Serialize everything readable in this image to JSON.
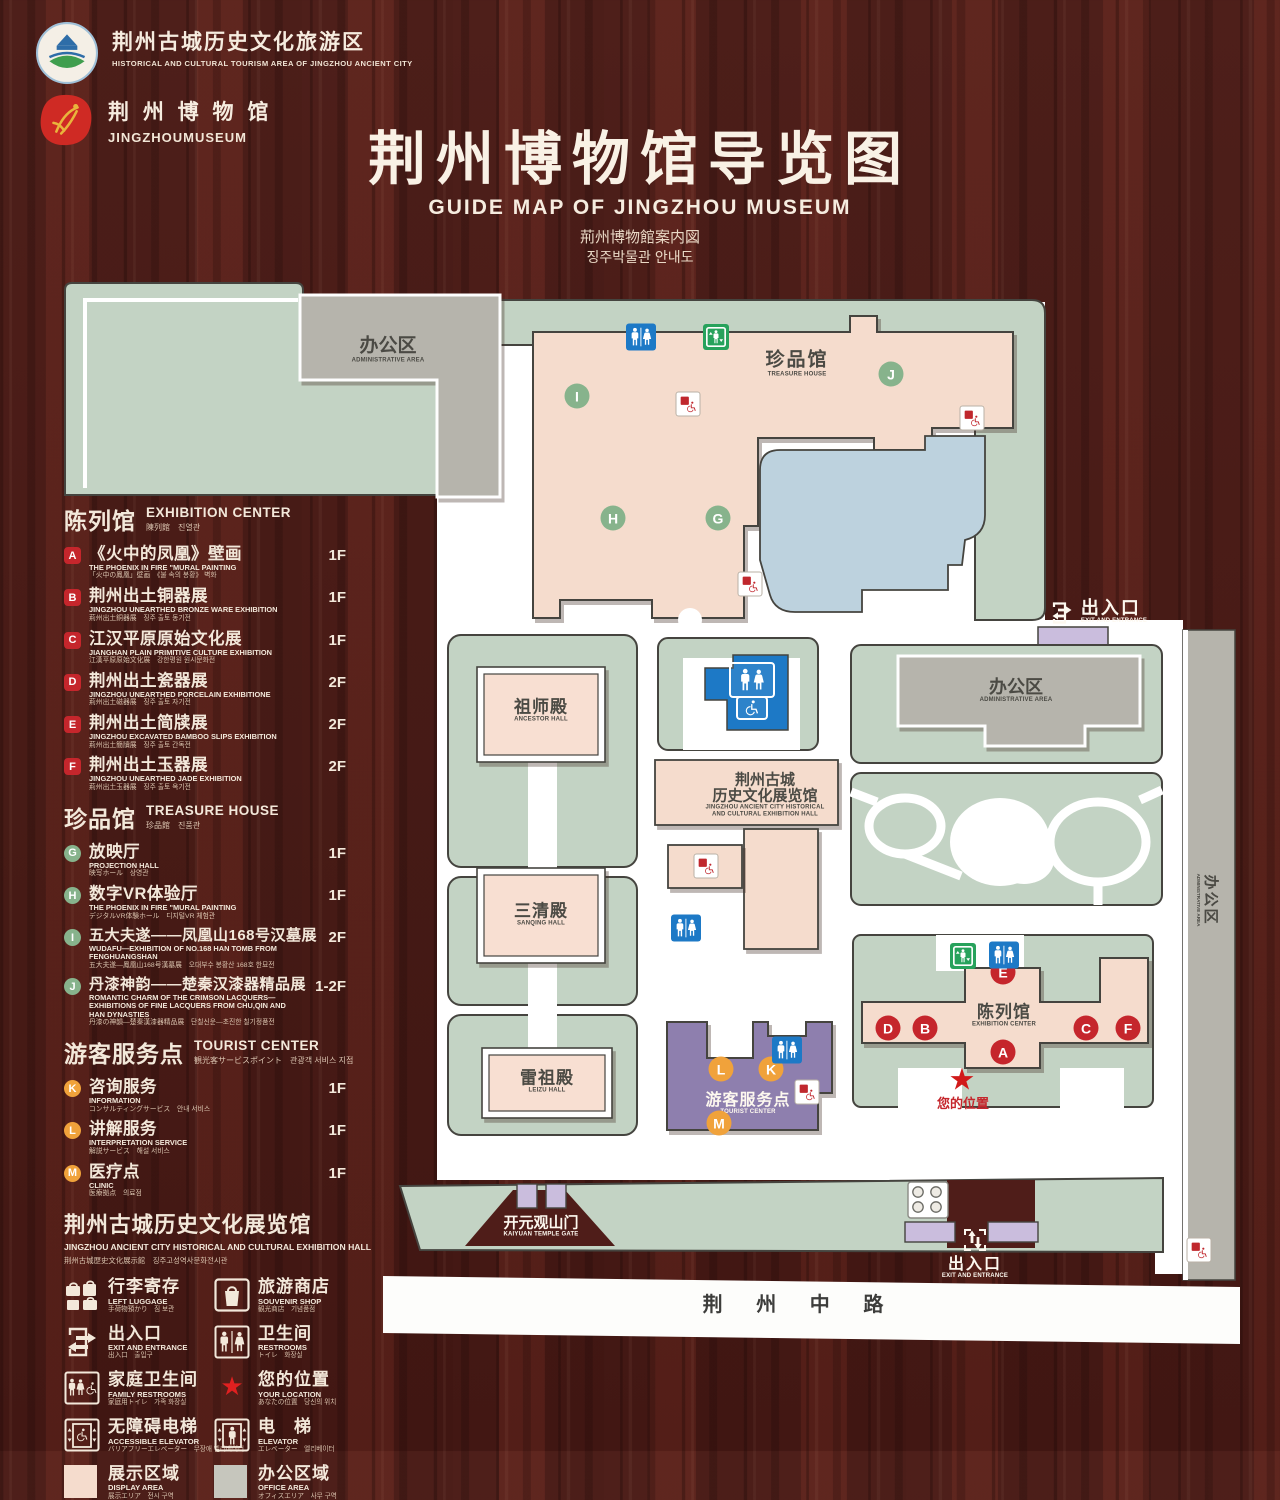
{
  "header": {
    "org1": {
      "cn": "荆州古城历史文化旅游区",
      "en": "HISTORICAL AND CULTURAL TOURISM AREA OF JINGZHOU ANCIENT CITY"
    },
    "org2": {
      "cn": "荆 州 博 物 馆",
      "en": "JINGZHOUMUSEUM"
    },
    "title": "荆州博物馆导览图",
    "subtitle_en": "GUIDE MAP OF JINGZHOU MUSEUM",
    "subtitle_jp": "荊州博物館案内図",
    "subtitle_kr": "징주박물관 안내도"
  },
  "legend": {
    "sections": [
      {
        "title_cn": "陈列馆",
        "title_en": "EXHIBITION CENTER",
        "title_sub": "陳列館　진열관",
        "items": [
          {
            "letter": "A",
            "name": "《火中的凤凰》壁画",
            "en": "THE PHOENIX IN FIRE \"MURAL PAINTING",
            "sub": "「火中の鳳凰」壁画　《불 속의 봉황》 벽화",
            "floor": "1F"
          },
          {
            "letter": "B",
            "name": "荆州出土铜器展",
            "en": "JINGZHOU UNEARTHED BRONZE WARE EXHIBITION",
            "sub": "荊州出土銅器展　징주 출토 동기전",
            "floor": "1F"
          },
          {
            "letter": "C",
            "name": "江汉平原原始文化展",
            "en": "JIANGHAN PLAIN PRIMITIVE CULTURE EXHIBITION",
            "sub": "江漢平原原始文化展　강한평원 원시문화전",
            "floor": "1F"
          },
          {
            "letter": "D",
            "name": "荆州出土瓷器展",
            "en": "JINGZHOU UNEARTHED PORCELAIN EXHIBITIONE",
            "sub": "荊州出土磁器展　징주 출토 자기전",
            "floor": "2F"
          },
          {
            "letter": "E",
            "name": "荆州出土简牍展",
            "en": "JINGZHOU EXCAVATED BAMBOO SLIPS EXHIBITION",
            "sub": "荊州出土簡牘展　징주 출토 간독전",
            "floor": "2F"
          },
          {
            "letter": "F",
            "name": "荆州出土玉器展",
            "en": "JINGZHOU UNEARTHED JADE EXHIBITION",
            "sub": "荊州出土玉器展　징주 출토 옥기전",
            "floor": "2F"
          }
        ]
      },
      {
        "title_cn": "珍品馆",
        "title_en": "TREASURE HOUSE",
        "title_sub": "珍品館　진품관",
        "items": [
          {
            "letter": "G",
            "name": "放映厅",
            "en": "PROJECTION HALL",
            "sub": "映写ホール　상영관",
            "floor": "1F"
          },
          {
            "letter": "H",
            "name": "数字VR体验厅",
            "en": "THE PHOENIX IN FIRE \"MURAL PAINTING",
            "sub": "デジタルVR体験ホール　디지털VR 체험관",
            "floor": "1F"
          },
          {
            "letter": "I",
            "name": "五大夫遂——凤凰山168号汉墓展",
            "en": "WUDAFU—EXHIBITION OF NO.168 HAN TOMB FROM FENGHUANGSHAN",
            "sub": "五大夫遂—鳳凰山168号漢墓展　오대부수 봉황산 168호 한묘전",
            "floor": "2F"
          },
          {
            "letter": "J",
            "name": "丹漆神韵——楚秦汉漆器精品展",
            "en": "ROMANTIC CHARM OF THE CRIMSON LACQUERS— EXHIBITIONS OF FINE LACQUERS FROM CHU,QIN AND HAN DYNASTIES",
            "sub": "丹漆の神韻—楚秦漢漆器精品展　단칠신운—초진한 칠기정품전",
            "floor": "1-2F"
          }
        ]
      },
      {
        "title_cn": "游客服务点",
        "title_en": "TOURIST CENTER",
        "title_sub": "観光客サービスポイント　관광객 서비스 지점",
        "items": [
          {
            "letter": "K",
            "name": "咨询服务",
            "en": "INFORMATION",
            "sub": "コンサルティングサービス　안내 서비스",
            "floor": "1F"
          },
          {
            "letter": "L",
            "name": "讲解服务",
            "en": "INTERPRETATION SERVICE",
            "sub": "解説サービス　해설 서비스",
            "floor": "1F"
          },
          {
            "letter": "M",
            "name": "医疗点",
            "en": "CLINIC",
            "sub": "医療拠点　의료점",
            "floor": "1F"
          }
        ]
      }
    ],
    "hall_note": {
      "cn": "荆州古城历史文化展览馆",
      "en": "JINGZHOU ANCIENT CITY HISTORICAL AND CULTURAL EXHIBITION HALL",
      "sub": "荆州古城歴史文化展示館　징주고성역사문화전시관"
    },
    "facilities": [
      {
        "cn": "行李寄存",
        "en": "LEFT LUGGAGE",
        "sub": "手荷物預かり　짐 보관",
        "icon": "luggage-icon"
      },
      {
        "cn": "旅游商店",
        "en": "SOUVENIR SHOP",
        "sub": "観光商店　기념품점",
        "icon": "souvenir-icon"
      },
      {
        "cn": "出入口",
        "en": "EXIT AND ENTRANCE",
        "sub": "出入口　출입구",
        "icon": "exit-entrance-icon"
      },
      {
        "cn": "卫生间",
        "en": "RESTROOMS",
        "sub": "トイレ　화장실",
        "icon": "restrooms-icon"
      },
      {
        "cn": "家庭卫生间",
        "en": "FAMILY RESTROOMS",
        "sub": "家庭用トイレ　가족 화장실",
        "icon": "family-restrooms-icon"
      },
      {
        "cn": "您的位置",
        "en": "YOUR LOCATION",
        "sub": "あなたの位置　당신의 위치",
        "icon": "location-star-icon"
      },
      {
        "cn": "无障碍电梯",
        "en": "ACCESSIBLE ELEVATOR",
        "sub": "バリアフリーエレベーター　무장애 엘리베이터",
        "icon": "accessible-elevator-icon"
      },
      {
        "cn": "电　梯",
        "en": "ELEVATOR",
        "sub": "エレベーター　엘리베이터",
        "icon": "elevator-icon"
      }
    ],
    "areas": [
      {
        "cn": "展示区域",
        "en": "DISPLAY AREA",
        "sub": "展示エリア　전시 구역",
        "color": "#f5dccd"
      },
      {
        "cn": "办公区域",
        "en": "OFFICE AREA",
        "sub": "オフィスエリア　사무 구역",
        "color": "#c6c6bd"
      }
    ]
  },
  "map": {
    "labels": {
      "admin_cn": "办公区",
      "admin_en": "ADMINISTRATIVE AREA",
      "treasure_cn": "珍品馆",
      "treasure_en": "TREASURE HOUSE",
      "exit_cn": "出入口",
      "exit_en": "EXIT AND ENTRANCE",
      "ancestor_cn": "祖师殿",
      "ancestor_en": "ANCESTOR HALL",
      "sanqing_cn": "三清殿",
      "sanqing_en": "SANQING HALL",
      "leizu_cn": "雷祖殿",
      "leizu_en": "LEIZU HALL",
      "exhhall_cn1": "荆州古城",
      "exhhall_cn2": "历史文化展览馆",
      "exhhall_en1": "JINGZHOU ANCIENT CITY HISTORICAL",
      "exhhall_en2": "AND CULTURAL EXHIBITION HALL",
      "exhcenter_cn": "陈列馆",
      "exhcenter_en": "EXHIBITION CENTER",
      "tourist_cn": "游客服务点",
      "tourist_en": "TOURIST CENTER",
      "your_location": "您的位置",
      "gate_cn": "开元观山门",
      "gate_en": "KAIYUAN TEMPLE GATE",
      "road": "荆 州 中 路"
    },
    "markers": [
      {
        "letter": "I"
      },
      {
        "letter": "J"
      },
      {
        "letter": "H"
      },
      {
        "letter": "G"
      },
      {
        "letter": "E"
      },
      {
        "letter": "D"
      },
      {
        "letter": "B"
      },
      {
        "letter": "C"
      },
      {
        "letter": "F"
      },
      {
        "letter": "A"
      },
      {
        "letter": "L"
      },
      {
        "letter": "K"
      },
      {
        "letter": "M"
      }
    ],
    "colors": {
      "marker_red": "#c5262c",
      "marker_green": "#87b38c",
      "marker_orange": "#f0a23b",
      "restroom_blue": "#1d79c6",
      "elevator_green": "#27a25c",
      "accessible_red": "#c0272d",
      "display_pink": "#f5dccd",
      "office_gray": "#b6b4ac",
      "lawn_green": "#c3d3c4",
      "pond_blue": "#bdd2de",
      "tourist_purple": "#8e7fae",
      "small_purple": "#cabddd",
      "road_white": "#fdfdfb"
    }
  }
}
